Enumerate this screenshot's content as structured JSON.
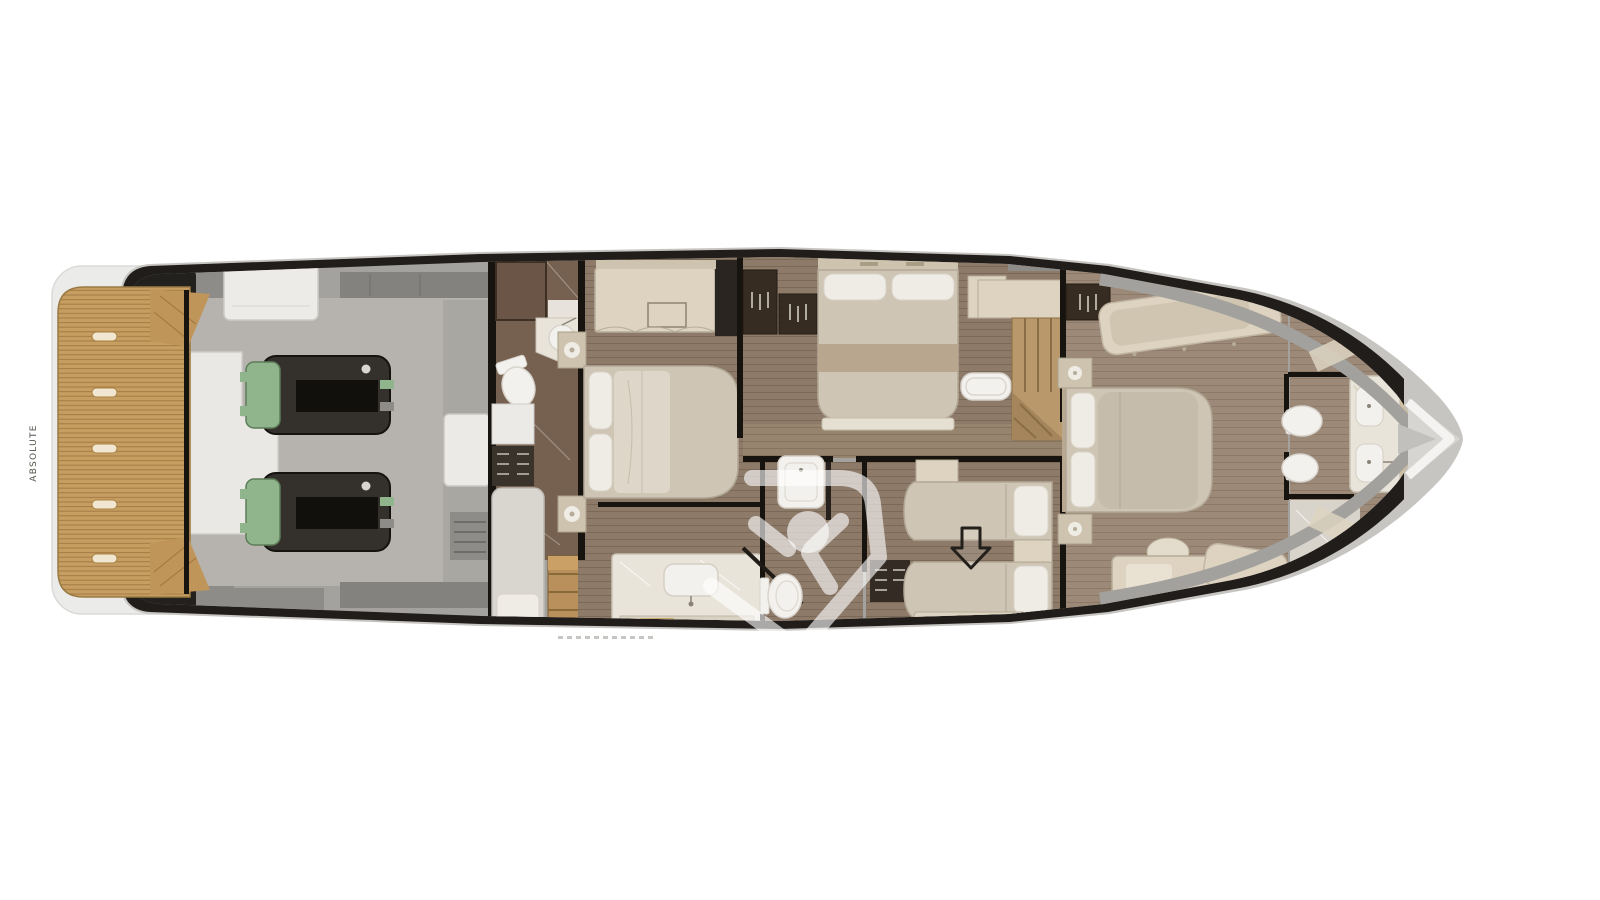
{
  "page": {
    "background": "#ffffff",
    "description": "Top-view lower-deck floor plan of a motor yacht, bow pointing right"
  },
  "branding": {
    "platform_label": "ABSOLUTE",
    "watermark_icon": "absolute-shield-figure-watermark"
  },
  "icons": {
    "direction_arrow": "down-arrow",
    "watermark_figure": "person-raised-arms-icon"
  },
  "colors": {
    "page_bg": "#ffffff",
    "hull_black": "#201d1a",
    "hull_gray": "#c7c5c2",
    "stern_cap": "#ebebe9",
    "walkway": "#a4a29e",
    "engine_floor": "#b6b3ae",
    "engine_body": "#34302b",
    "engine_green": "#90b48c",
    "teak": "#c79e62",
    "floor_mid": "#8d7a69",
    "floor_fwd": "#9c8977",
    "corridor": "#97846f",
    "marble_dark": "#76604f",
    "marble_light": "#e9e4da",
    "fixture_white": "#f3f1ed",
    "cream": "#ddd3c0",
    "cream_dark": "#cdc3ae",
    "mattress": "#cfc5b4",
    "pillow": "#efece6",
    "wardrobe": "#362c21",
    "wall": "#17140f",
    "watermark": "rgba(255,255,255,0.62)",
    "arrow": "#23201c"
  }
}
